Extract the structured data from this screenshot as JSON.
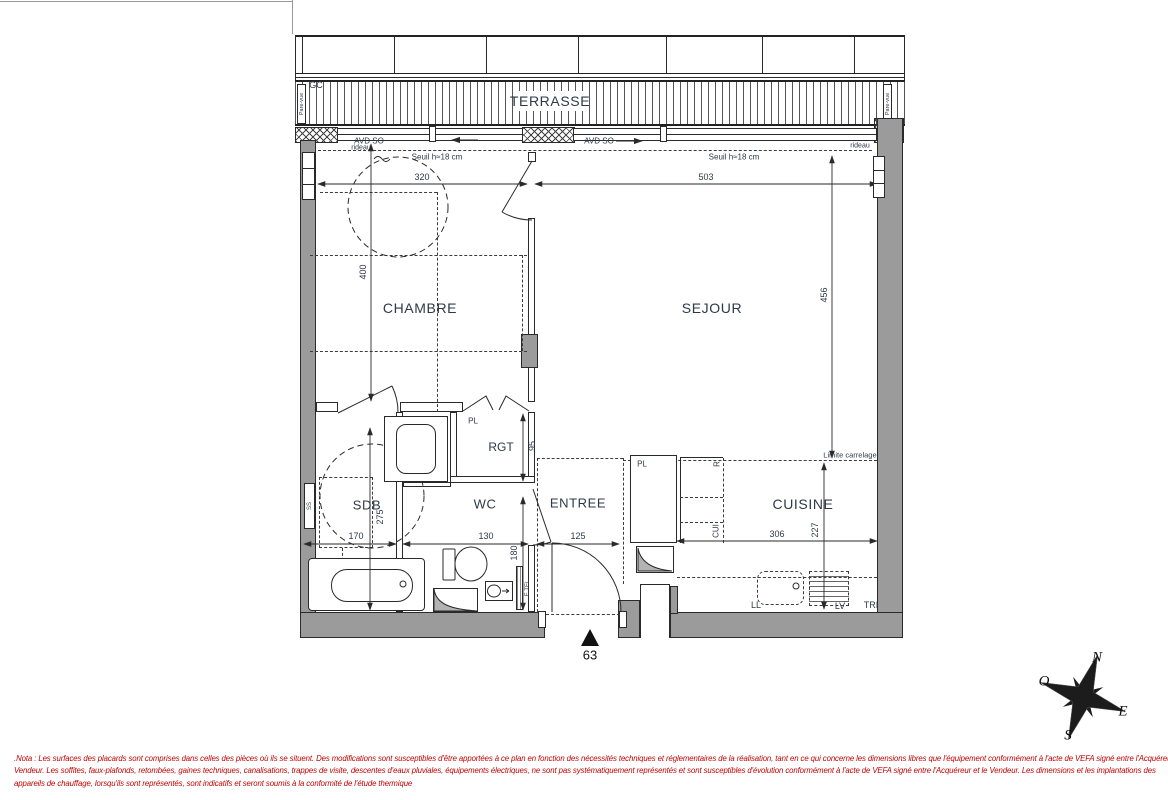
{
  "terrace": {
    "label": "TERRASSE",
    "gc_label": "GC",
    "pare_vue_left": "Pare-vue",
    "pare_vue_right": "Pare-vue",
    "avd_so_left": "AVD SO",
    "avd_so_right": "AVD SO",
    "rideau_left": "rideau",
    "rideau_right": "rideau",
    "seuil_left": "Seuil h≈18 cm",
    "seuil_right": "Seuil h≈18 cm"
  },
  "rooms": {
    "chambre": "CHAMBRE",
    "sejour": "SEJOUR",
    "sdb": "SDB",
    "wc": "WC",
    "entree": "ENTREE",
    "cuisine": "CUISINE",
    "rgt": "RGT"
  },
  "closets": {
    "rgt_pl": "PL",
    "cuisine_pl": "PL"
  },
  "dimensions_cm": {
    "chambre_width": "320",
    "sejour_width": "503",
    "chambre_depth": "400",
    "sejour_depth": "456",
    "sdb_width": "170",
    "wc_width": "130",
    "entree_width": "125",
    "sdb_depth": "275",
    "wc_depth": "180",
    "rgt_depth": "95",
    "cuisine_width": "306",
    "cuisine_depth": "227"
  },
  "kitchen_labels": {
    "fridge": "R",
    "counter": "CUI",
    "washer": "LL",
    "dishwasher": "LV",
    "bin": "TRI",
    "tile_limit": "Limite carrelage."
  },
  "fixtures": {
    "towel_dryer": "SS",
    "electrical": "E.TEL"
  },
  "entrance": {
    "unit_number": "63"
  },
  "compass": {
    "north": "N",
    "south": "S",
    "east": "E",
    "west": "O"
  },
  "nota": {
    "line1": ".Nota : Les surfaces des placards sont comprises dans celles des pièces où ils se situent. Des modifications sont susceptibles d'être apportées à ce plan en fonction des nécessités techniques et réglementaires de la réalisation, tant en ce qui concerne les dimensions libres que l'équipement conformément à l'acte de VEFA signé entre l'Acquéreur et le",
    "line2": "Vendeur. Les soffites, faux-plafonds, retombées, gaines techniques, canalisations, trappes de visite, descentes d'eaux pluviales, équipements électriques, ne sont pas systématiquement représentés et sont susceptibles d'évolution  conformément à l'acte de VEFA signé entre l'Acquéreur et le Vendeur. Les dimensions et les implantations des",
    "line3": "appareils de chauffage, lorsqu'ils sont représentés, sont indicatifs et seront soumis à la conformité de l'étude thermique"
  },
  "colors": {
    "wall_fill": "#9b9b9b",
    "line": "#2a2a2a",
    "text": "#2e3947",
    "nota_red": "#c00000"
  }
}
